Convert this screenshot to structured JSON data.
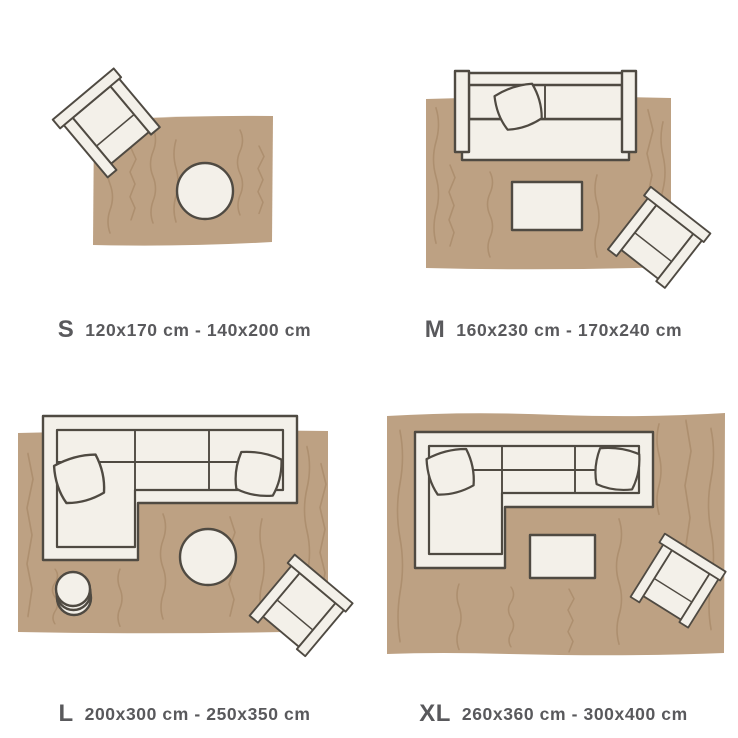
{
  "palette": {
    "background": "#ffffff",
    "rug": "#bda183",
    "rug_line": "#a1815f",
    "furniture": "#f3f0e9",
    "outline": "#4f4a42",
    "text": "#59595c"
  },
  "panels": [
    {
      "id": "s",
      "letter": "S",
      "dims": "120x170 cm - 140x200 cm",
      "items": [
        "rug",
        "armchair-icon",
        "round-ottoman-icon"
      ]
    },
    {
      "id": "m",
      "letter": "M",
      "dims": "160x230 cm - 170x240 cm",
      "items": [
        "rug",
        "sofa-icon",
        "pillow-icon",
        "coffee-table-icon",
        "armchair-icon"
      ]
    },
    {
      "id": "l",
      "letter": "L",
      "dims": "200x300 cm - 250x350 cm",
      "items": [
        "rug",
        "sectional-sofa-icon",
        "pillow-icon",
        "pillow-icon",
        "round-ottoman-icon",
        "side-table-icon",
        "armchair-icon"
      ]
    },
    {
      "id": "xl",
      "letter": "XL",
      "dims": "260x360 cm - 300x400 cm",
      "items": [
        "rug",
        "sectional-sofa-icon",
        "pillow-icon",
        "pillow-icon",
        "coffee-table-icon",
        "armchair-icon"
      ]
    }
  ]
}
